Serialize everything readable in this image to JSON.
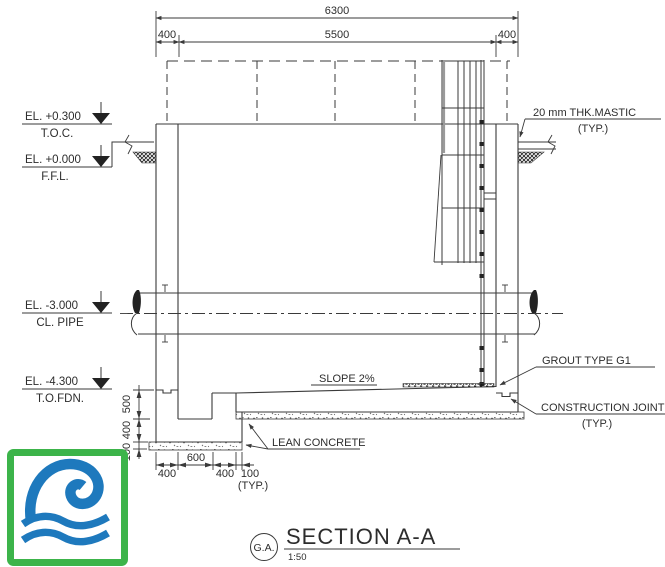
{
  "drawing": {
    "dims": {
      "overall": "6300",
      "left_wall": "400",
      "interior": "5500",
      "right_wall": "400",
      "pit_depth": "500",
      "pit_slab": "400",
      "lean_thk": "100",
      "b1": "400",
      "b2": "600",
      "b3": "400",
      "b4": "100",
      "b_typ": "(TYP.)"
    },
    "elevations": {
      "toc_el": "EL. +0.300",
      "toc_ref": "T.O.C.",
      "ffl_el": "EL. +0.000",
      "ffl_ref": "F.F.L.",
      "pipe_el": "EL. -3.000",
      "pipe_ref": "CL. PIPE",
      "fdn_el": "EL. -4.300",
      "fdn_ref": "T.O.FDN."
    },
    "notes": {
      "mastic": "20 mm THK.MASTIC",
      "mastic_typ": "(TYP.)",
      "grout": "GROUT TYPE G1",
      "cj": "CONSTRUCTION JOINT",
      "cj_typ": "(TYP.)",
      "slope": "SLOPE 2%",
      "lean": "LEAN CONCRETE"
    },
    "title": {
      "bubble": "G.A.",
      "text": "SECTION A-A",
      "scale": "1:50"
    }
  },
  "logo": {
    "name": "wave-logo",
    "border_color": "#3cb44a",
    "wave_color": "#1e79bd"
  },
  "colors": {
    "line": "#3a3a3a",
    "text": "#2d2d2d"
  }
}
